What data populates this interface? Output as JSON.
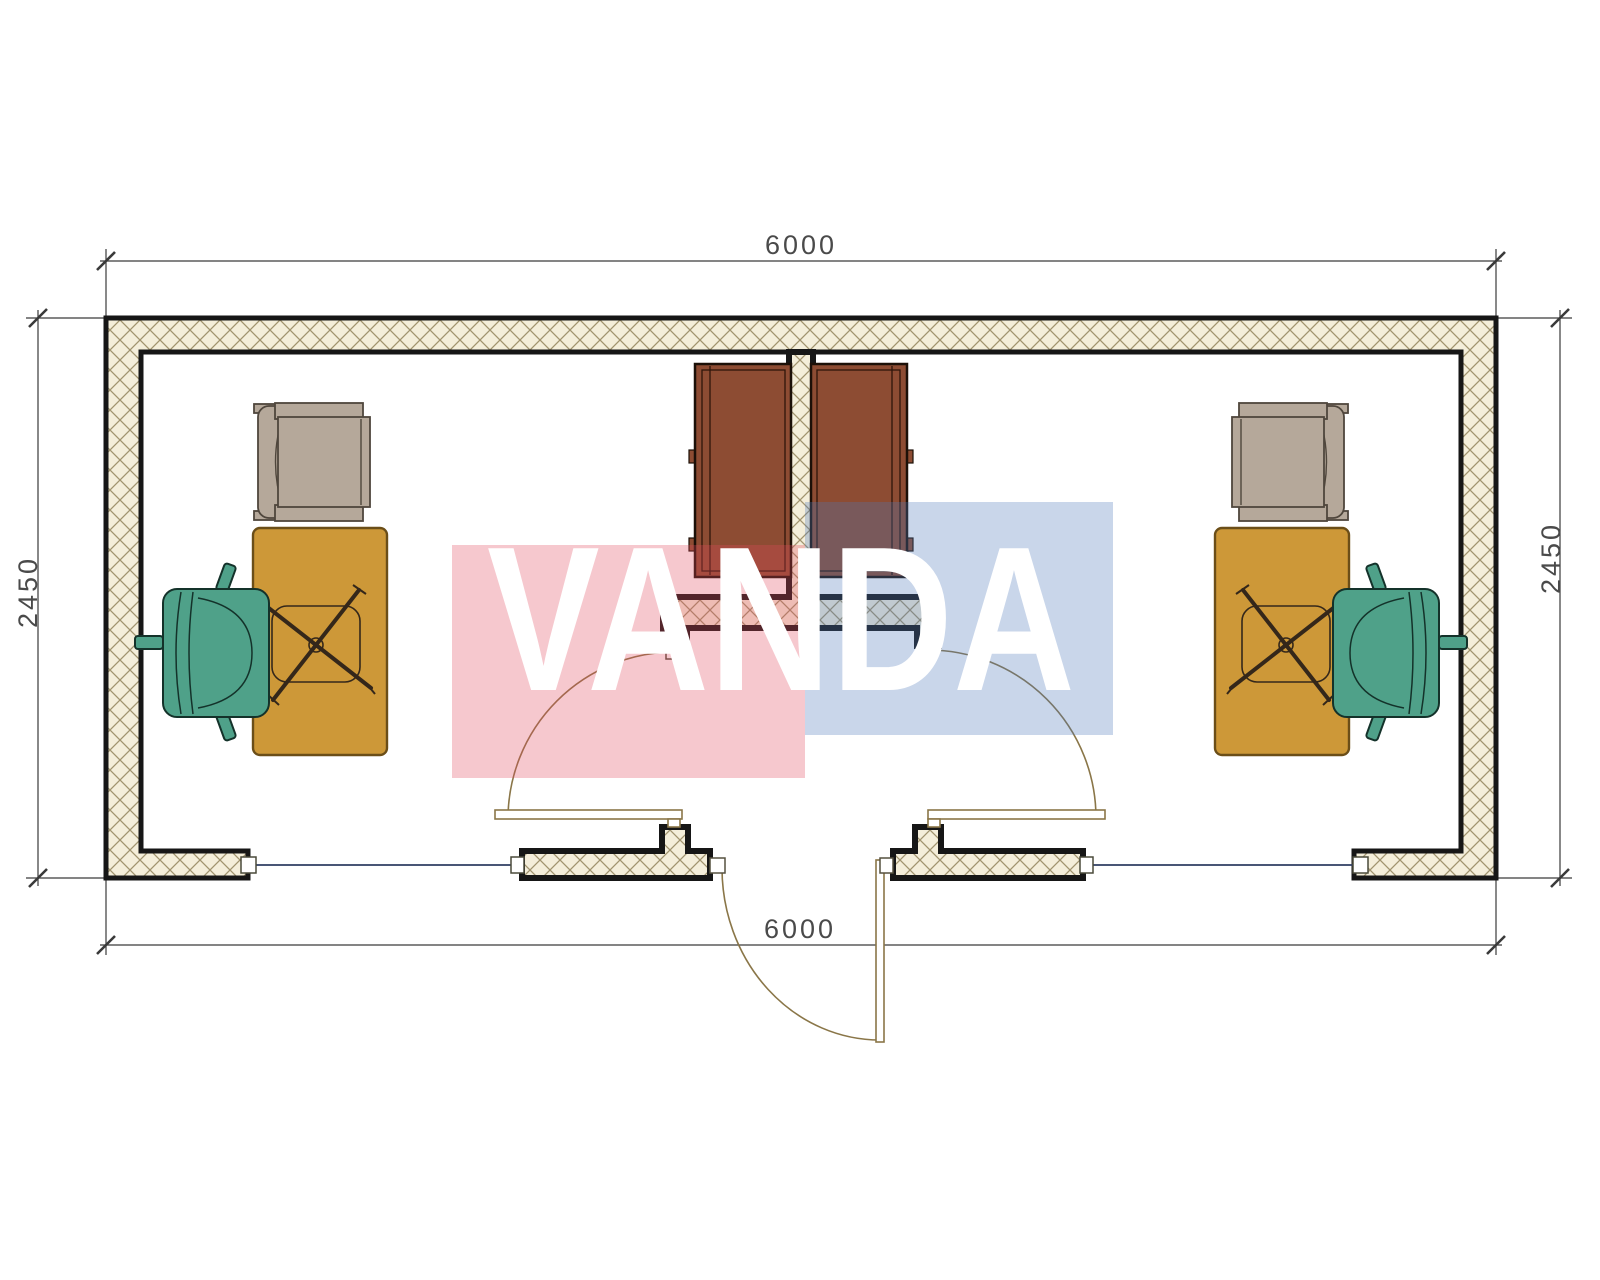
{
  "plan": {
    "dimensions": {
      "top": "6000",
      "bottom": "6000",
      "left": "2450",
      "right": "2450"
    },
    "watermark": {
      "text": "VANDA",
      "text_color": "#ffffff",
      "pink_block_color": "rgba(225,72,92,0.30)",
      "blue_block_color": "rgba(75,118,185,0.30)"
    },
    "colors": {
      "wall_hatch_bg": "#f4eeda",
      "wall_hatch_line": "#a1946f",
      "wall_outline": "#161616",
      "desk": "#cd9838",
      "chair_green": "#4fa189",
      "armchair_gray": "#b5a89a",
      "cabinet_brown": "#8d4c33",
      "door_symbol": "#8a7648",
      "window_line": "#2f3e63",
      "dimension_line": "#3a3a3a",
      "dimension_text": "#4a4a4a"
    }
  }
}
